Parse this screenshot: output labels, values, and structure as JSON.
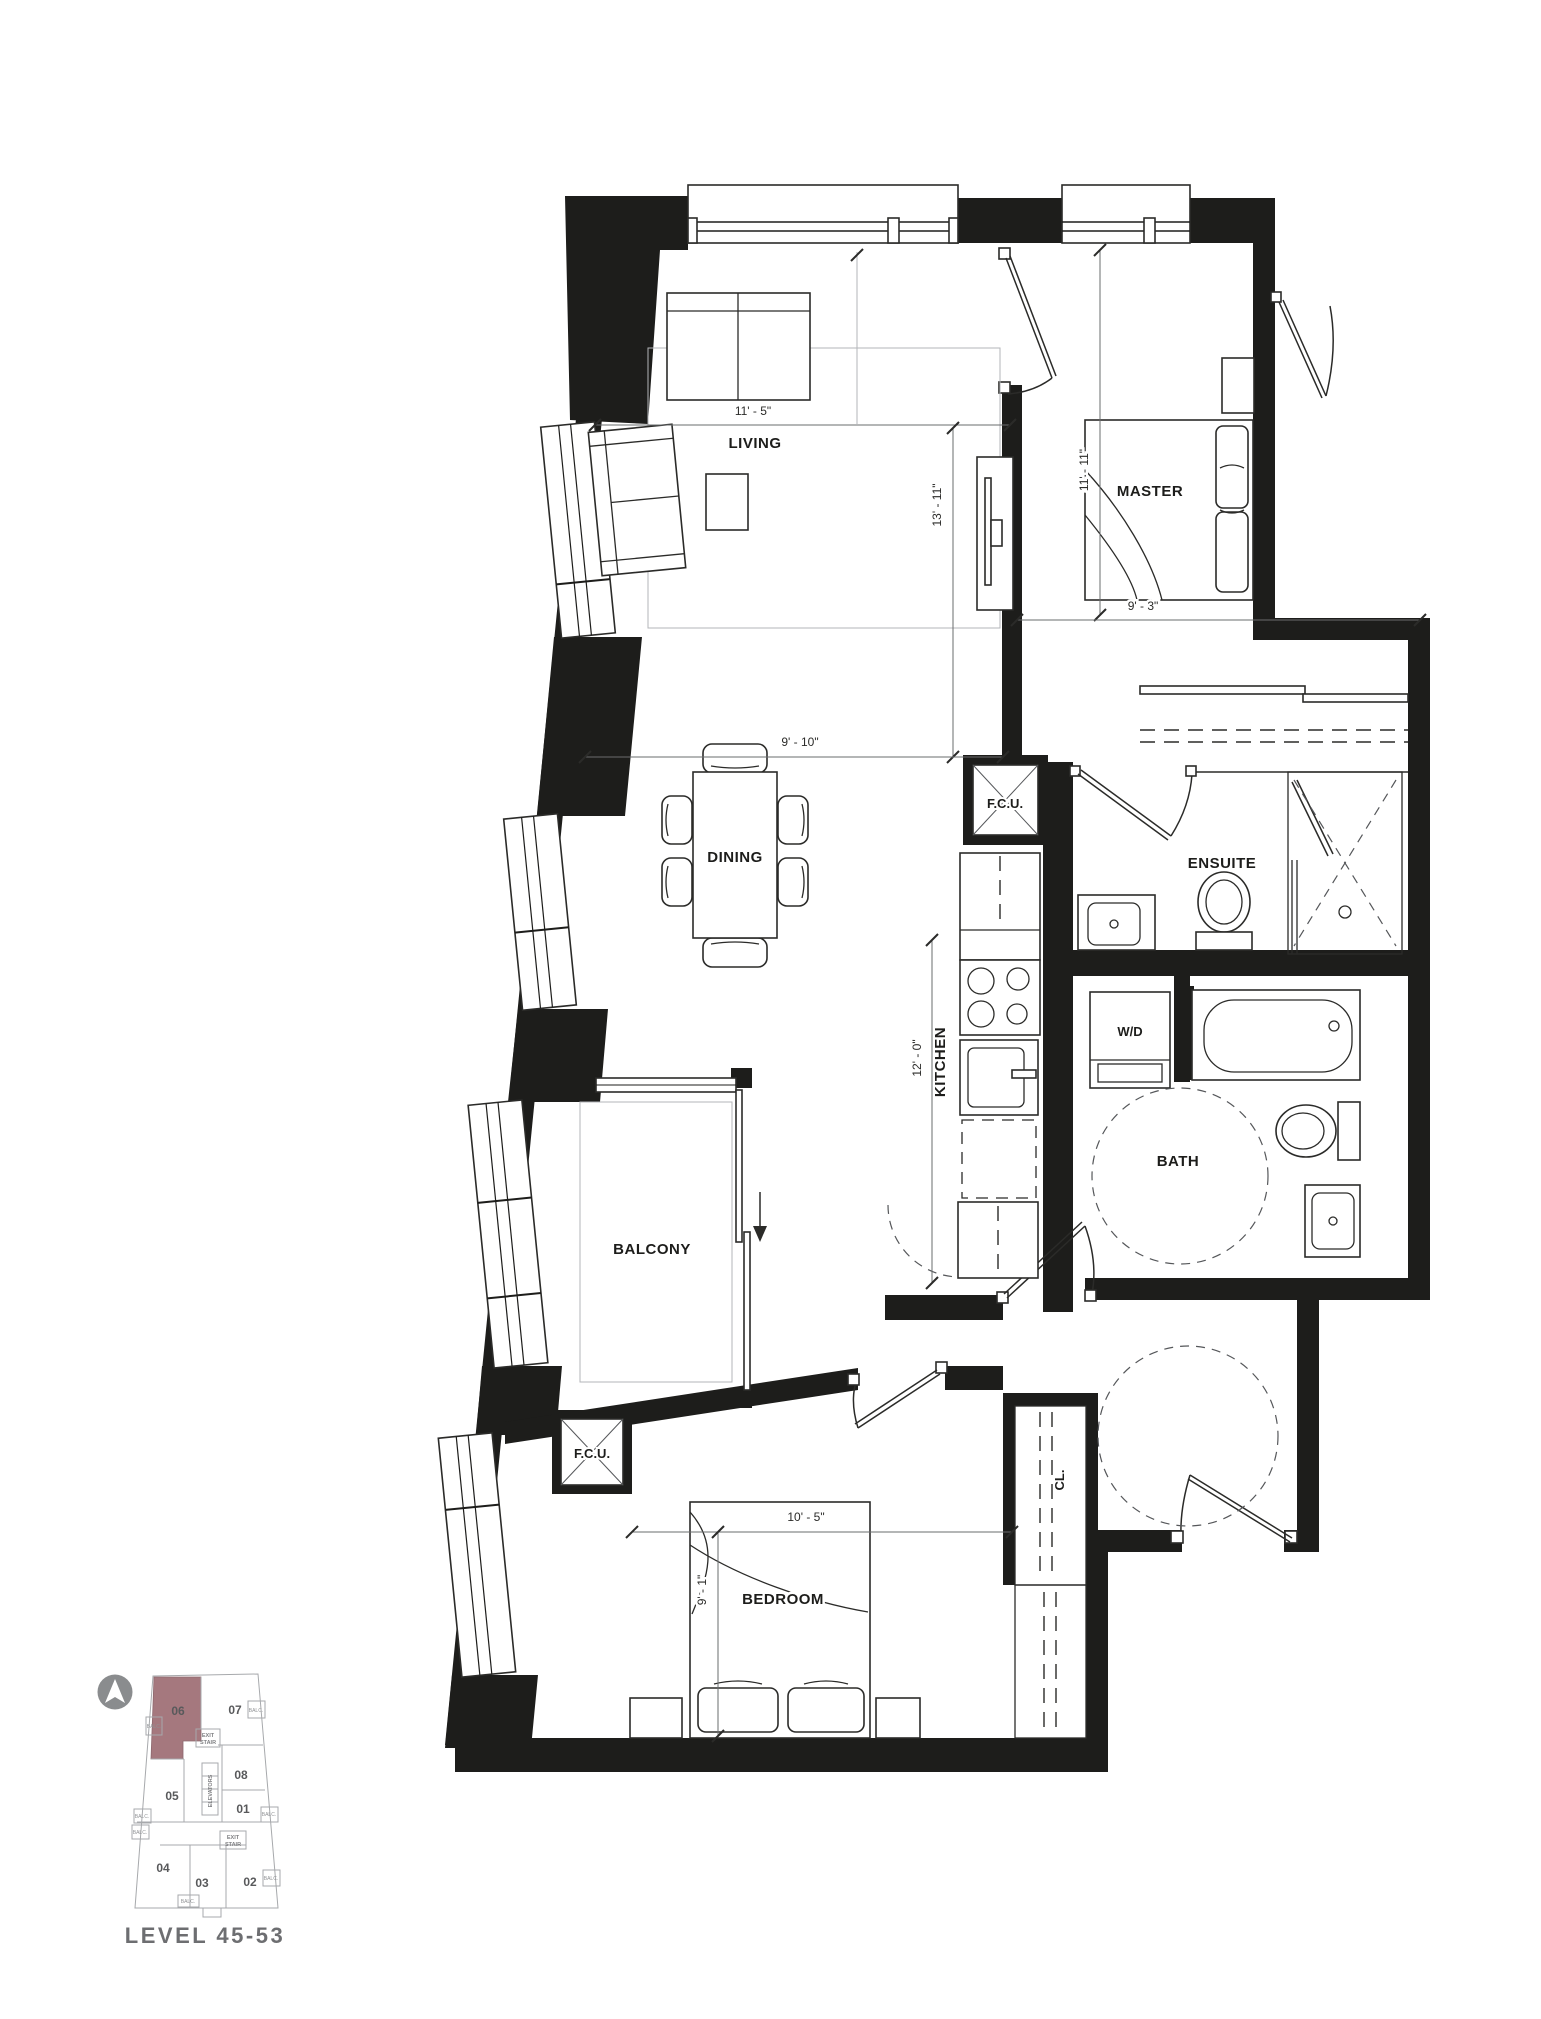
{
  "plan": {
    "rooms": {
      "living": "LIVING",
      "master": "MASTER",
      "dining": "DINING",
      "kitchen": "KITCHEN",
      "ensuite": "ENSUITE",
      "bath": "BATH",
      "wd": "W/D",
      "balcony": "BALCONY",
      "bedroom": "BEDROOM",
      "closet": "CL.",
      "fcu": "F.C.U."
    },
    "dims": {
      "living_w": "11' - 5\"",
      "living_d": "13' - 11\"",
      "master_d": "11' - 11\"",
      "master_w": "9' - 3\"",
      "dining_w": "9' - 10\"",
      "kitchen_d": "12' - 0\"",
      "bedroom_w": "10' - 5\"",
      "bedroom_d": "9' - 1\""
    }
  },
  "keyplan": {
    "level": "LEVEL 45-53",
    "highlighted_unit": "06",
    "units": {
      "u01": "01",
      "u02": "02",
      "u03": "03",
      "u04": "04",
      "u05": "05",
      "u06": "06",
      "u07": "07",
      "u08": "08"
    },
    "exit_stair_l1": "EXIT",
    "exit_stair_l2": "STAIR",
    "elevators": "ELEVATORS",
    "balc": "BALC."
  },
  "colors": {
    "wall": "#1d1d1b",
    "highlight": "#a5787e",
    "keyplan_text": "#6d6e71"
  }
}
